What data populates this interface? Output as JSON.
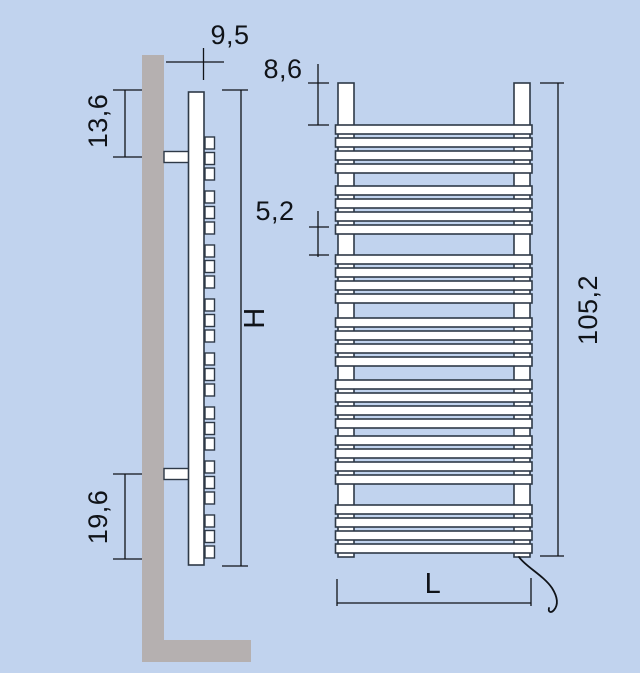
{
  "title": "towel-radiator-dimension-drawing",
  "dimensions": {
    "wall_distance": "9,5",
    "upper_bracket_offset": "13,6",
    "top_to_first_tube": "8,6",
    "tube_group_gap": "5,2",
    "height_symbol": "H",
    "lower_bracket_offset": "19,6",
    "overall_height": "105,2",
    "width_symbol": "L"
  },
  "front_view": {
    "tube_groups": 7,
    "tubes_per_group": 4
  },
  "side_view": {
    "tube_groups": 8,
    "tubes_per_group": 3
  },
  "colors": {
    "background": "#c1d3ee",
    "wall": "#b5b0b0",
    "radiator_outline": "#2e3947",
    "dimension_lines": "#101318",
    "radiator_fill": "#ffffff"
  }
}
